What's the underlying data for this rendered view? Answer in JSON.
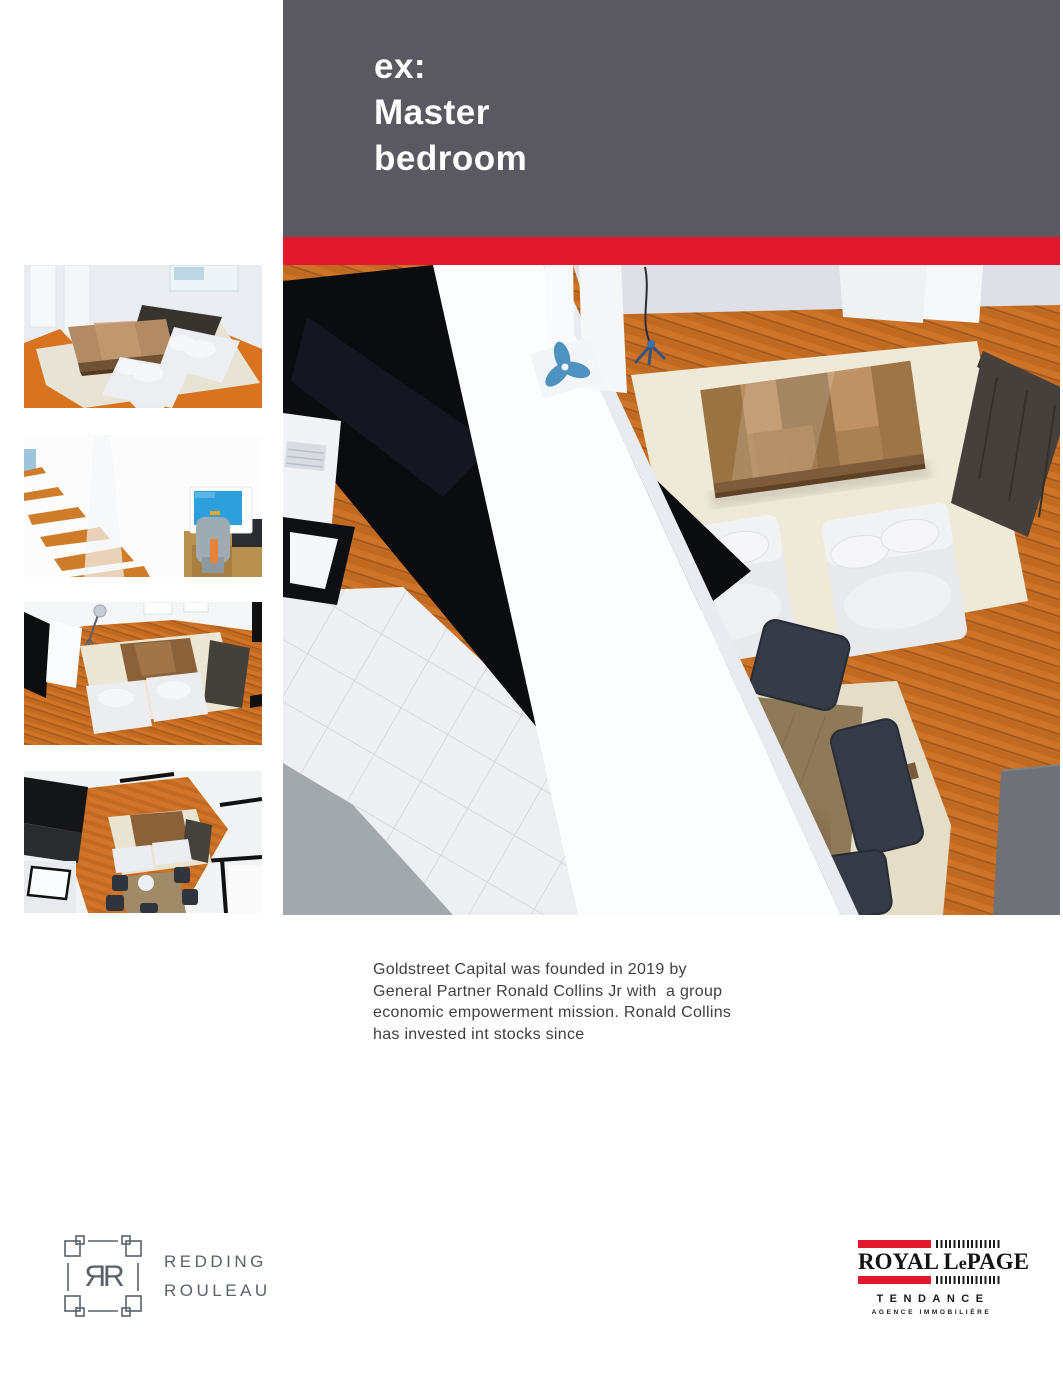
{
  "colors": {
    "header_bg": "#5a5962",
    "accent_red": "#e2192c",
    "body_text": "#3e3e40",
    "logo_gray": "#59616b"
  },
  "header": {
    "title_lines": [
      "ex:",
      "Master",
      "bedroom"
    ]
  },
  "gallery": {
    "thumbnails": [
      {
        "alt": "3D render thumbnail - living room with dark sofa, wood coffee table and two white sofas"
      },
      {
        "alt": "3D render thumbnail - wooden staircase beside a desk with computer monitor and grey chair"
      },
      {
        "alt": "3D render thumbnail - overhead view of living room with rug, coffee table and sofas"
      },
      {
        "alt": "3D render thumbnail - overhead view of open-plan kitchen, living and dining area"
      }
    ],
    "main": {
      "alt": "3D render - top-down view of open-plan living and dining room with wood floor"
    }
  },
  "body_text": {
    "lines": [
      "Goldstreet Capital was founded in 2019 by",
      "General Partner Ronald Collins Jr with  a group",
      "economic empowerment mission. Ronald Collins",
      "has invested int stocks since"
    ]
  },
  "footer": {
    "redding_rouleau": {
      "monogram": "ЯR",
      "name_line1": "REDDING",
      "name_line2": "ROULEAU"
    },
    "royal_lepage": {
      "wordmark_part1": "ROYAL L",
      "wordmark_part2": "e",
      "wordmark_part3": "PAGE",
      "subtitle": "TENDANCE",
      "tagline": "AGENCE IMMOBILIÈRE"
    }
  }
}
